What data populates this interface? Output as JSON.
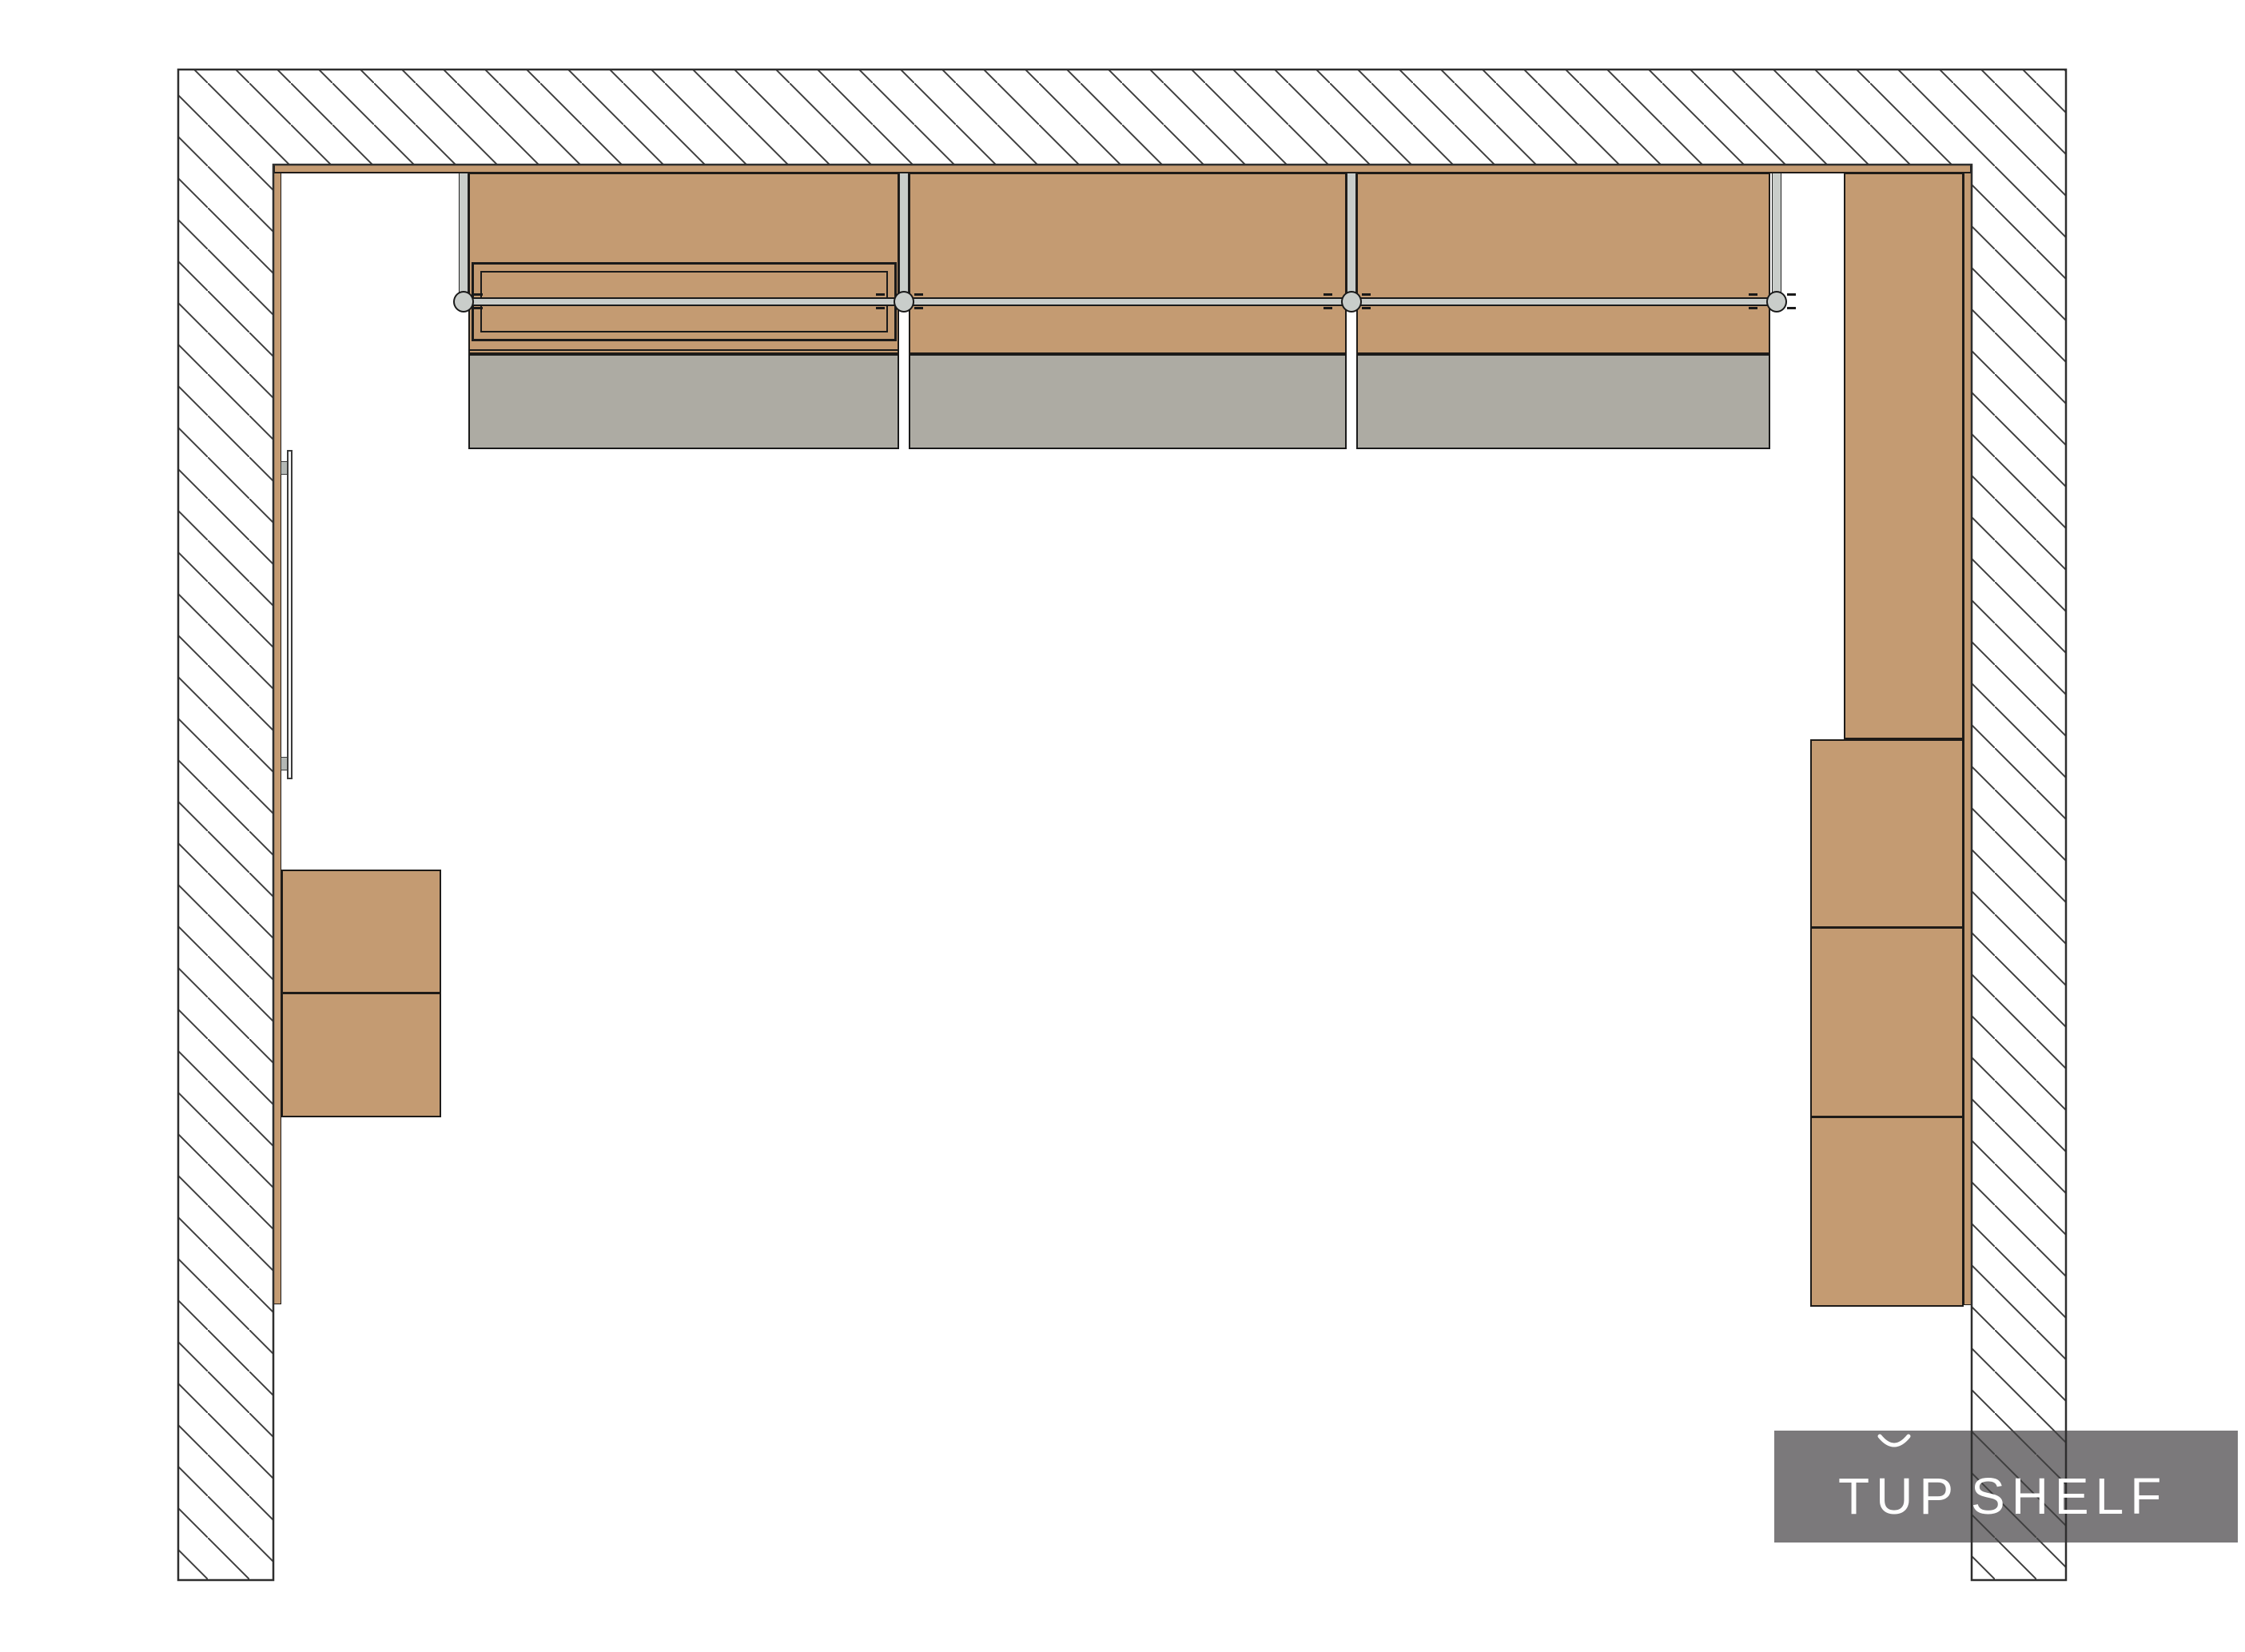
{
  "document": {
    "type": "architectural plan drawing",
    "view": "top-down closet / wardrobe floor plan"
  },
  "logo": {
    "brand": "TOP SHELF",
    "parts": {
      "t": "T",
      "o": "U",
      "p": "P",
      "shelf": "SHELF"
    },
    "o_diacritic": "breve arc above the U forming a stylized O",
    "panel_color": "#7b797b",
    "text_color": "#ffffff"
  },
  "colors": {
    "background": "#ffffff",
    "wood": "#c49b72",
    "cabinet_outline": "#1e1b18",
    "metal_light": "#c9cdca",
    "shelf_gray": "#adaba3",
    "wall_line": "#2e2e2e",
    "hatch_line": "#3f3f3f",
    "mirror_bracket": "#b4b8b5"
  },
  "plan": {
    "walls": [
      {
        "id": "wall-top",
        "fill": "diagonal hatch"
      },
      {
        "id": "wall-left",
        "fill": "diagonal hatch"
      },
      {
        "id": "wall-right",
        "fill": "diagonal hatch"
      }
    ],
    "top_wall_run": {
      "bays": 3,
      "hanging_rod": {
        "brackets": 4,
        "bracket_shape": "circle"
      },
      "bay_1_extra": "double-framed pull-out box",
      "lower_shelf_blocks": 3,
      "divider_panels": 4
    },
    "left_wall_run": {
      "wall_panel_strip": true,
      "mirror": {
        "mounted": "wall",
        "brackets": 2
      },
      "drawer_boxes": 2
    },
    "right_wall_run": {
      "wall_panel_strip": true,
      "tall_cabinet_panel": true,
      "stacked_boxes": 3
    }
  }
}
